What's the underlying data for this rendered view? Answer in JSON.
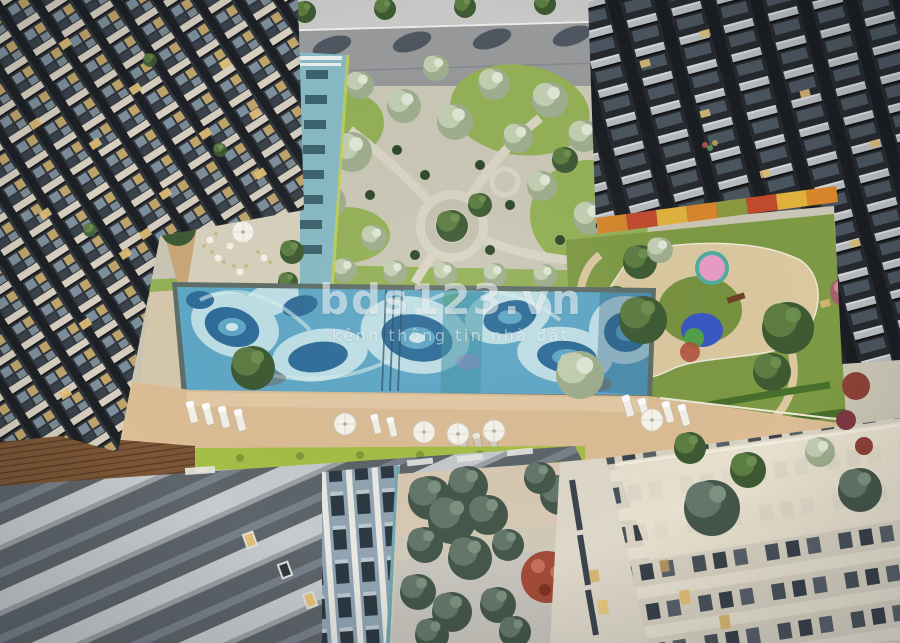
{
  "window": {
    "width": 900,
    "height": 643
  },
  "scene": {
    "type": "architectural aerial 3D render",
    "subject": "Top-down courtyard view of a residential complex: swimming pool with wavy mosaic, pool deck with sun loungers and parasols, central tree garden with circular plaza, kids playground, street with trees, and surrounding apartment towers"
  },
  "watermark": {
    "brand": "bds123.vn",
    "tagline": "kênh thông tin nhà đất"
  },
  "palette": {
    "road": "#98999b",
    "sidewalk": "#c8c8c6",
    "paving": "#cbc6b5",
    "grass": "#93b156",
    "hedge": "#a6bf46",
    "lawn": "#7e9a44",
    "pool_base": "#5fa8c8",
    "pool_dark": "#2e6d9a",
    "pool_pale": "#bfe0e8",
    "pool_teal": "#3f94a4",
    "pool_rim": "#5f6e68",
    "deck": "#dcbd95",
    "deck_light": "#e6cda9",
    "wood": "#7c5636",
    "tower_dark": "#31363c",
    "slab_cream": "#d6cfc0",
    "slab_light": "#b7bbbf",
    "window_warm": "#e3c078",
    "glass": "#7d8f9c",
    "teal_building": "#87bac5",
    "blue_building": "#90a4b2",
    "beige_building": "#ded8ca",
    "tree_dark": "#3d5a33",
    "tree_green": "#5c7d42",
    "tree_sage": "#9fae8e",
    "tree_red": "#a34b38",
    "play_pink": "#e89cc5",
    "play_blue": "#3a57c4",
    "awning_orange": "#d8862c",
    "awning_red": "#c24a2e",
    "awning_yellow": "#e0b23c",
    "watermark": "rgba(255,255,255,0.55)",
    "watermark_soft": "rgba(255,255,255,0.5)"
  }
}
